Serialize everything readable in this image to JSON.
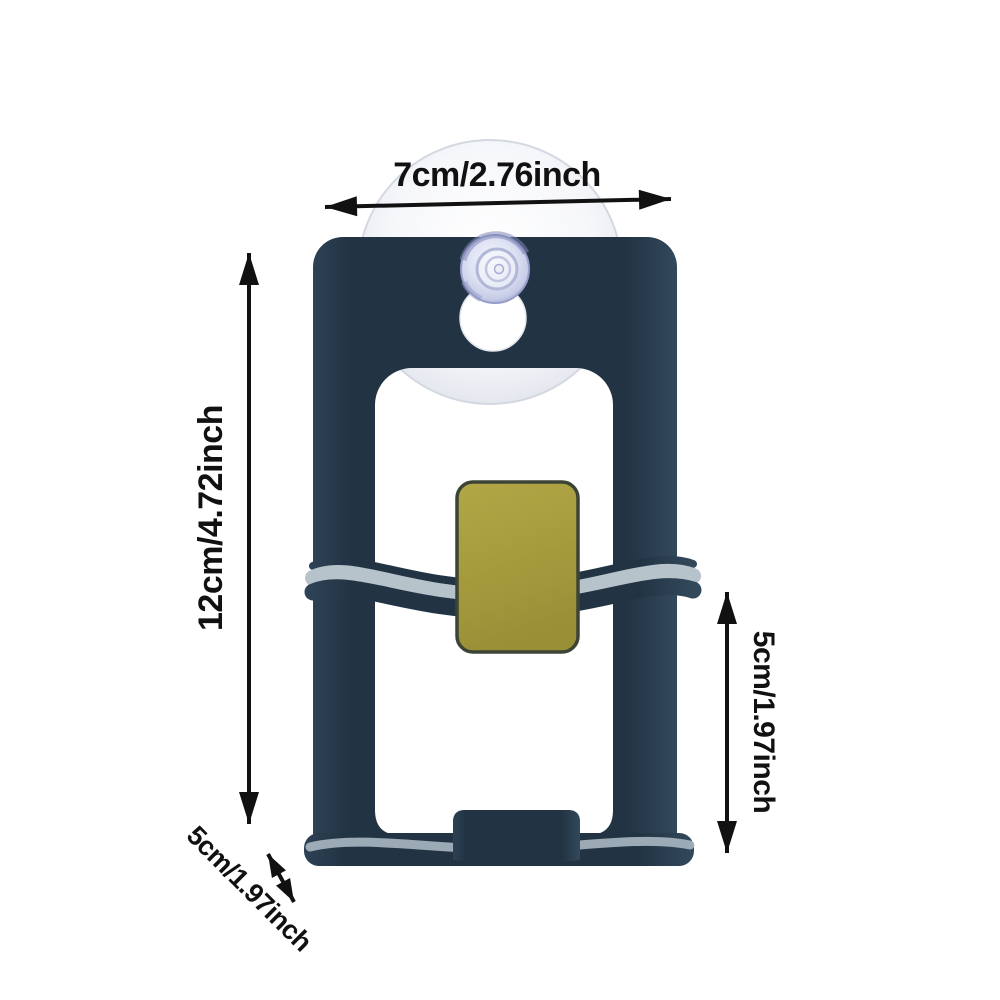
{
  "image_type": "product dimension diagram",
  "product": {
    "subject": "wall-mounted holder bracket with suction cup and adhesive pad"
  },
  "dimensions": {
    "width_label": "7cm/2.76inch",
    "height_label": "12cm/4.72inch",
    "side_height_label": "5cm/1.97inch",
    "depth_label": "5cm/1.97inch"
  },
  "colors": {
    "background": "#ffffff",
    "product_body": "#24374a",
    "adhesive_pad": "#a89e42",
    "suction_cup_knob": "#c9cde8",
    "suction_cup_disc": "#f3f4f8",
    "shelf_highlight": "#b7c3cb",
    "annotation_ink": "#111111"
  }
}
